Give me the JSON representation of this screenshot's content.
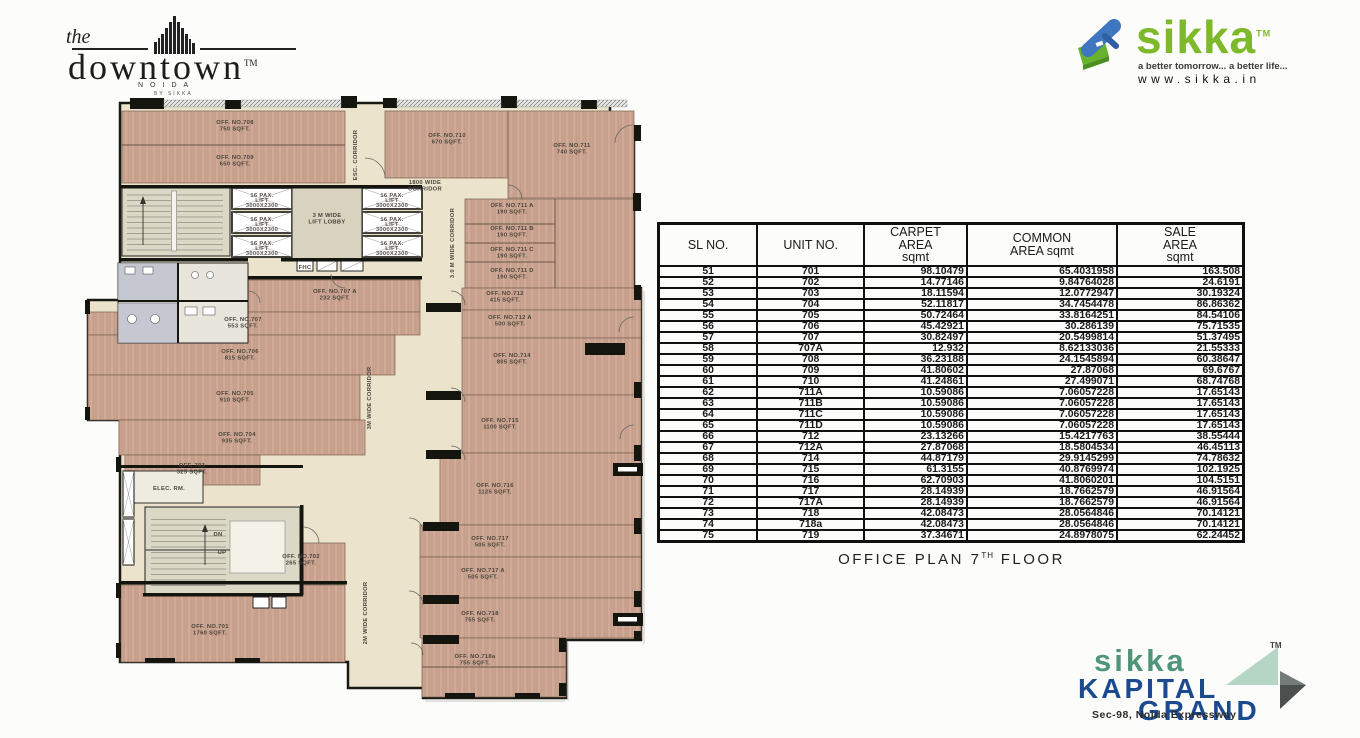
{
  "branding": {
    "downtown": {
      "the": "the",
      "name": "downtown",
      "tm": "TM",
      "city": "NOIDA",
      "by": "BY SIKKA"
    },
    "sikka": {
      "name": "sikka",
      "tm": "TM",
      "tagline": "a better tomorrow... a better life...",
      "url": "www.sikka.in",
      "green": "#7db928",
      "blue": "#3e76c0"
    },
    "kapital": {
      "sikka": "sikka",
      "line1": "KAPITAL",
      "line2": "GRAND",
      "tm": "TM",
      "address": "Sec-98, Noida Expressway",
      "teal": "#4f9678",
      "navy": "#1b4a8f"
    }
  },
  "table": {
    "headers": [
      [
        "SL NO."
      ],
      [
        "UNIT NO."
      ],
      [
        "CARPET",
        "AREA",
        "sqmt"
      ],
      [
        "COMMON",
        "AREA sqmt"
      ],
      [
        "SALE",
        "AREA",
        "sqmt"
      ]
    ],
    "rows": [
      [
        "51",
        "701",
        "98.10479",
        "65.4031958",
        "163.508"
      ],
      [
        "52",
        "702",
        "14.77146",
        "9.84764028",
        "24.6191"
      ],
      [
        "53",
        "703",
        "18.11594",
        "12.0772947",
        "30.19324"
      ],
      [
        "54",
        "704",
        "52.11817",
        "34.7454478",
        "86.86362"
      ],
      [
        "55",
        "705",
        "50.72464",
        "33.8164251",
        "84.54106"
      ],
      [
        "56",
        "706",
        "45.42921",
        "30.286139",
        "75.71535"
      ],
      [
        "57",
        "707",
        "30.82497",
        "20.5499814",
        "51.37495"
      ],
      [
        "58",
        "707A",
        "12.932",
        "8.62133036",
        "21.55333"
      ],
      [
        "59",
        "708",
        "36.23188",
        "24.1545894",
        "60.38647"
      ],
      [
        "60",
        "709",
        "41.80602",
        "27.87068",
        "69.6767"
      ],
      [
        "61",
        "710",
        "41.24861",
        "27.499071",
        "68.74768"
      ],
      [
        "62",
        "711A",
        "10.59086",
        "7.06057228",
        "17.65143"
      ],
      [
        "63",
        "711B",
        "10.59086",
        "7.06057228",
        "17.65143"
      ],
      [
        "64",
        "711C",
        "10.59086",
        "7.06057228",
        "17.65143"
      ],
      [
        "65",
        "711D",
        "10.59086",
        "7.06057228",
        "17.65143"
      ],
      [
        "66",
        "712",
        "23.13266",
        "15.4217763",
        "38.55444"
      ],
      [
        "67",
        "712A",
        "27.87068",
        "18.5804534",
        "46.45113"
      ],
      [
        "68",
        "714",
        "44.87179",
        "29.9145299",
        "74.78632"
      ],
      [
        "69",
        "715",
        "61.3155",
        "40.8769974",
        "102.1925"
      ],
      [
        "70",
        "716",
        "62.70903",
        "41.8060201",
        "104.5151"
      ],
      [
        "71",
        "717",
        "28.14939",
        "18.7662579",
        "46.91564"
      ],
      [
        "72",
        "717A",
        "28.14939",
        "18.7662579",
        "46.91564"
      ],
      [
        "73",
        "718",
        "42.08473",
        "28.0564846",
        "70.14121"
      ],
      [
        "74",
        "718a",
        "42.08473",
        "28.0564846",
        "70.14121"
      ],
      [
        "75",
        "719",
        "37.34671",
        "24.8978075",
        "62.24452"
      ]
    ]
  },
  "caption": {
    "prefix": "OFFICE PLAN 7",
    "sup": "TH",
    "suffix": " FLOOR"
  },
  "plan": {
    "rooms": [
      {
        "name": "OFF. NO.708",
        "area": "750 SQFT.",
        "x": 150,
        "y": 29
      },
      {
        "name": "OFF. NO.709",
        "area": "650 SQFT.",
        "x": 150,
        "y": 64
      },
      {
        "name": "OFF. NO.710",
        "area": "670 SQFT.",
        "x": 362,
        "y": 42
      },
      {
        "name": "OFF. NO.711",
        "area": "740 SQFT.",
        "x": 487,
        "y": 52
      },
      {
        "name": "OFF. NO.711 A",
        "area": "190 SQFT.",
        "x": 427,
        "y": 112
      },
      {
        "name": "OFF. NO.711 B",
        "area": "190 SQFT.",
        "x": 427,
        "y": 135
      },
      {
        "name": "OFF. NO.711 C",
        "area": "190 SQFT.",
        "x": 427,
        "y": 156
      },
      {
        "name": "OFF. NO.711 D",
        "area": "190 SQFT.",
        "x": 427,
        "y": 177
      },
      {
        "name": "OFF. NO.712",
        "area": "415 SQFT.",
        "x": 420,
        "y": 200
      },
      {
        "name": "OFF. NO.712 A",
        "area": "500 SQFT.",
        "x": 425,
        "y": 224
      },
      {
        "name": "OFF. NO.714",
        "area": "805 SQFT.",
        "x": 427,
        "y": 262
      },
      {
        "name": "OFF. NO.715",
        "area": "1100 SQFT.",
        "x": 415,
        "y": 327
      },
      {
        "name": "OFF. NO.716",
        "area": "1125 SQFT.",
        "x": 410,
        "y": 392
      },
      {
        "name": "OFF. NO.717",
        "area": "505 SQFT.",
        "x": 405,
        "y": 445
      },
      {
        "name": "OFF. NO.717 A",
        "area": "505 SQFT.",
        "x": 398,
        "y": 477
      },
      {
        "name": "OFF. NO.718",
        "area": "755 SQFT.",
        "x": 395,
        "y": 520
      },
      {
        "name": "OFF. NO.718a",
        "area": "755 SQFT.",
        "x": 390,
        "y": 563
      },
      {
        "name": "OFF. NO.707 A",
        "area": "232 SQFT.",
        "x": 250,
        "y": 198
      },
      {
        "name": "OFF. NO.707",
        "area": "553 SQFT.",
        "x": 158,
        "y": 226
      },
      {
        "name": "OFF. NO.706",
        "area": "815 SQFT.",
        "x": 155,
        "y": 258
      },
      {
        "name": "OFF. NO.705",
        "area": "910 SQFT.",
        "x": 150,
        "y": 300
      },
      {
        "name": "OFF. NO.704",
        "area": "935 SQFT.",
        "x": 152,
        "y": 341
      },
      {
        "name": "OFF. 703",
        "area": "325 SQFT.",
        "x": 107,
        "y": 372
      },
      {
        "name": "OFF. NO.702",
        "area": "265 SQFT.",
        "x": 216,
        "y": 463
      },
      {
        "name": "OFF. NO.701",
        "area": "1760 SQFT.",
        "x": 125,
        "y": 533
      }
    ],
    "annotations": [
      {
        "lines": [
          "1800 WIDE",
          "CORRIDOR"
        ],
        "x": 340,
        "y": 89
      },
      {
        "lines": [
          "3.0 M WIDE CORRIDOR"
        ],
        "x": 369,
        "y": 148,
        "rot": -90,
        "size": 5
      },
      {
        "lines": [
          "ESC. CORRIDOR"
        ],
        "x": 272,
        "y": 60,
        "rot": -90,
        "size": 4.6
      },
      {
        "lines": [
          "3M WIDE CORRIDOR"
        ],
        "x": 286,
        "y": 303,
        "rot": -90,
        "size": 5
      },
      {
        "lines": [
          "2M WIDE CORRIDOR"
        ],
        "x": 282,
        "y": 518,
        "rot": -90,
        "size": 5
      },
      {
        "lines": [
          "3 M WIDE",
          "LIFT LOBBY"
        ],
        "x": 242,
        "y": 122
      },
      {
        "lines": [
          "ELEC. RM."
        ],
        "x": 84,
        "y": 395,
        "size": 5
      },
      {
        "lines": [
          "FHC"
        ],
        "x": 220,
        "y": 174,
        "size": 3.8
      },
      {
        "lines": [
          "DN"
        ],
        "x": 133,
        "y": 441,
        "size": 5.2
      },
      {
        "lines": [
          "UP"
        ],
        "x": 137,
        "y": 459,
        "size": 5.2
      }
    ],
    "lift_label": [
      "16 PAX.",
      "LIFT",
      "3000X2300"
    ],
    "lift_positions": [
      [
        177,
        102
      ],
      [
        177,
        126
      ],
      [
        177,
        150
      ],
      [
        307,
        102
      ],
      [
        307,
        126
      ],
      [
        307,
        150
      ]
    ]
  }
}
